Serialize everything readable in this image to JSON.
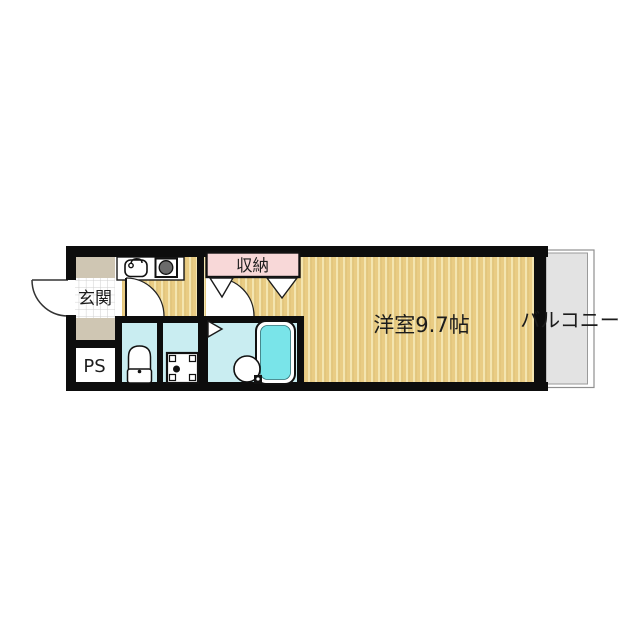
{
  "floor_plan": {
    "labels": {
      "entrance": "玄関",
      "pipe_space": "PS",
      "closet": "収納",
      "main_room": "洋室9.7帖",
      "balcony": "バルコニー"
    },
    "colors": {
      "wall": "#0d0d0d",
      "flooring": "#e9cc84",
      "flooring_stripe": "#f4e5b0",
      "flooring_stripe_edge": "#d8b869",
      "closet_pink": "#f8d8d8",
      "wet_area_blue": "#c9edf1",
      "bathtub_cyan": "#79e4e9",
      "balcony_gray": "#e3e3e3",
      "entrance_block_tan": "#cfc6b3",
      "tile_line_gray": "#cfcfcf",
      "stove_gray": "#6b6b6b",
      "outline": "#111111"
    }
  }
}
